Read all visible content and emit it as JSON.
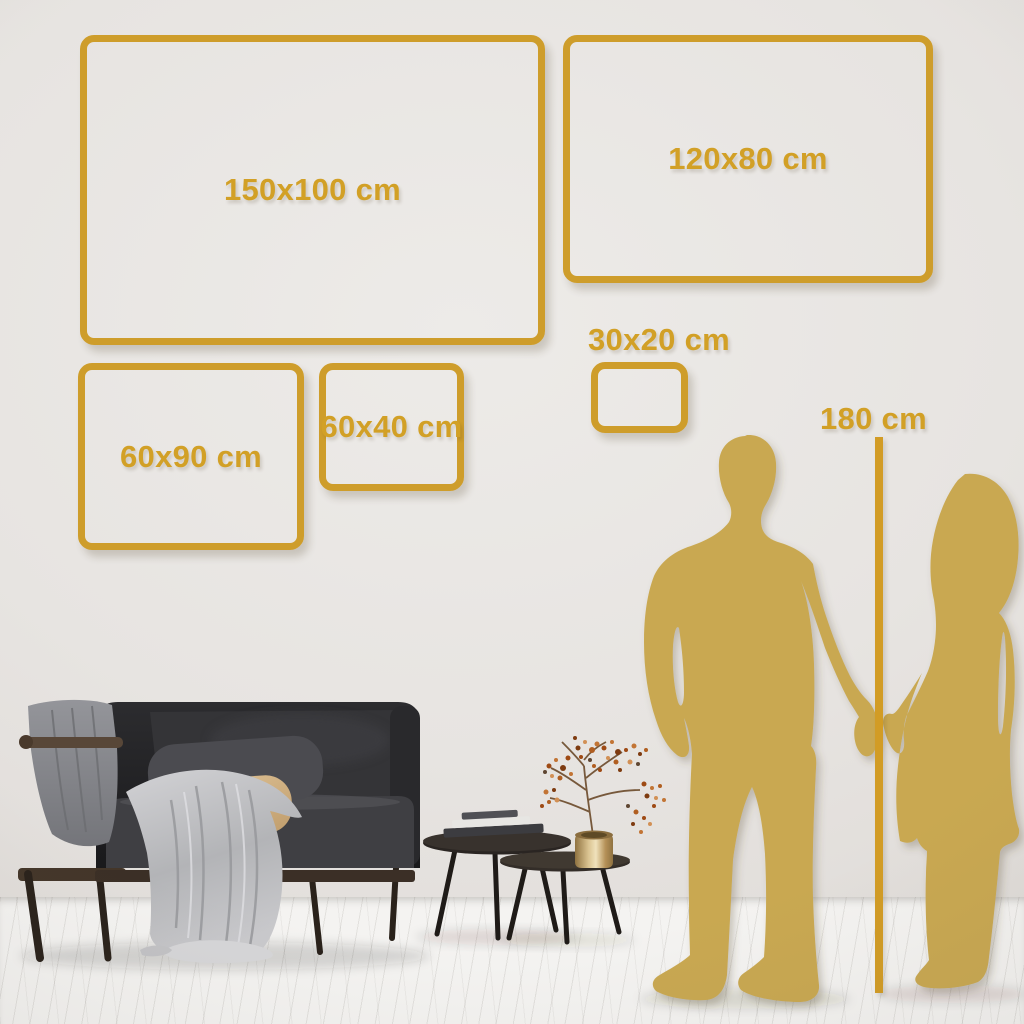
{
  "size_frames": [
    {
      "label": "150x100 cm"
    },
    {
      "label": "120x80 cm"
    },
    {
      "label": "60x90 cm"
    },
    {
      "label": "60x40 cm"
    },
    {
      "label": "30x20 cm"
    }
  ],
  "height_marker": {
    "label": "180 cm"
  },
  "colors": {
    "accent_gold": "#CE9D2B",
    "text_gold": "#D2A026",
    "line_gold": "#D29C25",
    "silhouette_gold": "#C9A851",
    "wall": "#E7E4E1",
    "floor": "#F4F3F1"
  },
  "scene_objects": [
    "sofa",
    "throw-blankets",
    "cushions",
    "nesting-coffee-tables",
    "books",
    "vase-with-dried-branch",
    "man-silhouette",
    "woman-silhouette",
    "height-measure-line"
  ]
}
